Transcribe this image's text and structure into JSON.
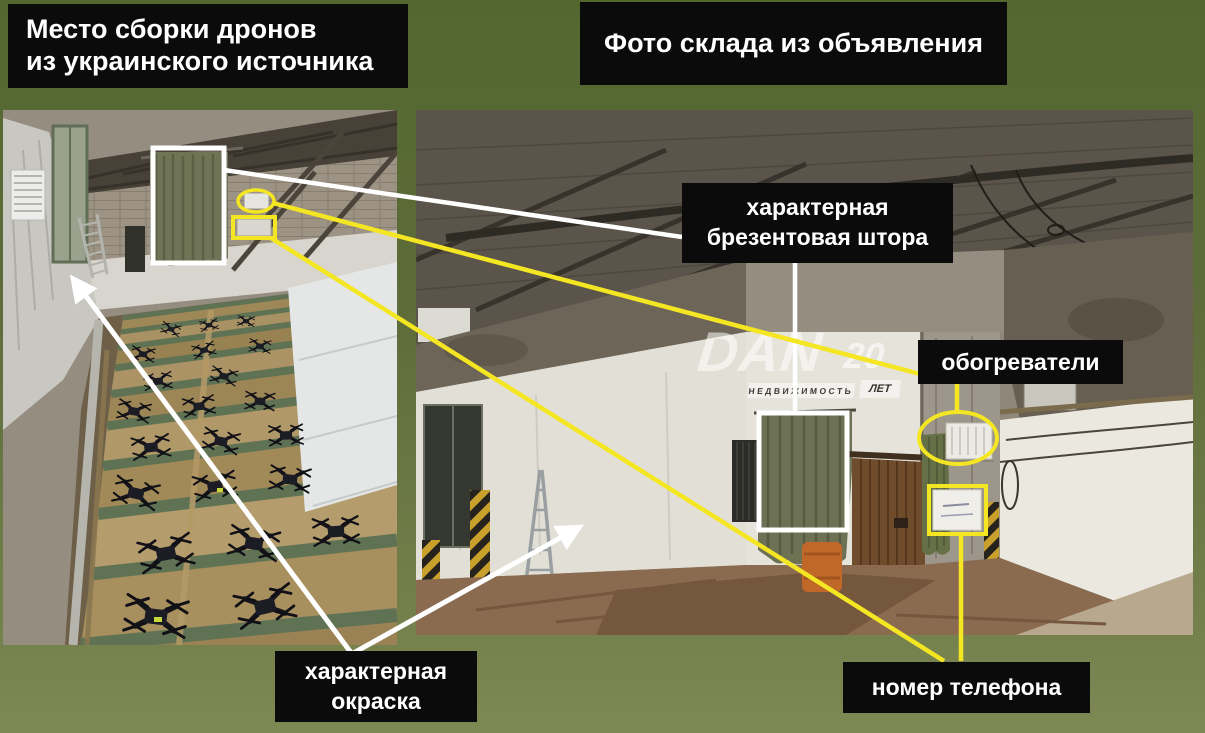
{
  "titles": {
    "left": "Место сборки дронов\nиз украинского источника",
    "right": "Фото склада из объявления"
  },
  "labels": {
    "curtain": "характерная\nбрезентовая штора",
    "heaters": "обогреватели",
    "paint": "характерная\nокраска",
    "phone": "номер телефона"
  },
  "watermark": {
    "brand": "DAN",
    "years_number": "20",
    "years_word": "ЛЕТ",
    "tagline": "НЕДВИЖИМОСТЬ"
  },
  "colors": {
    "annotation_yellow": "#f4e623",
    "annotation_white": "#ffffff",
    "label_background": "#0b0b0b",
    "label_text": "#ffffff",
    "background_top": "#54672f",
    "background_bottom": "#7d8853"
  }
}
